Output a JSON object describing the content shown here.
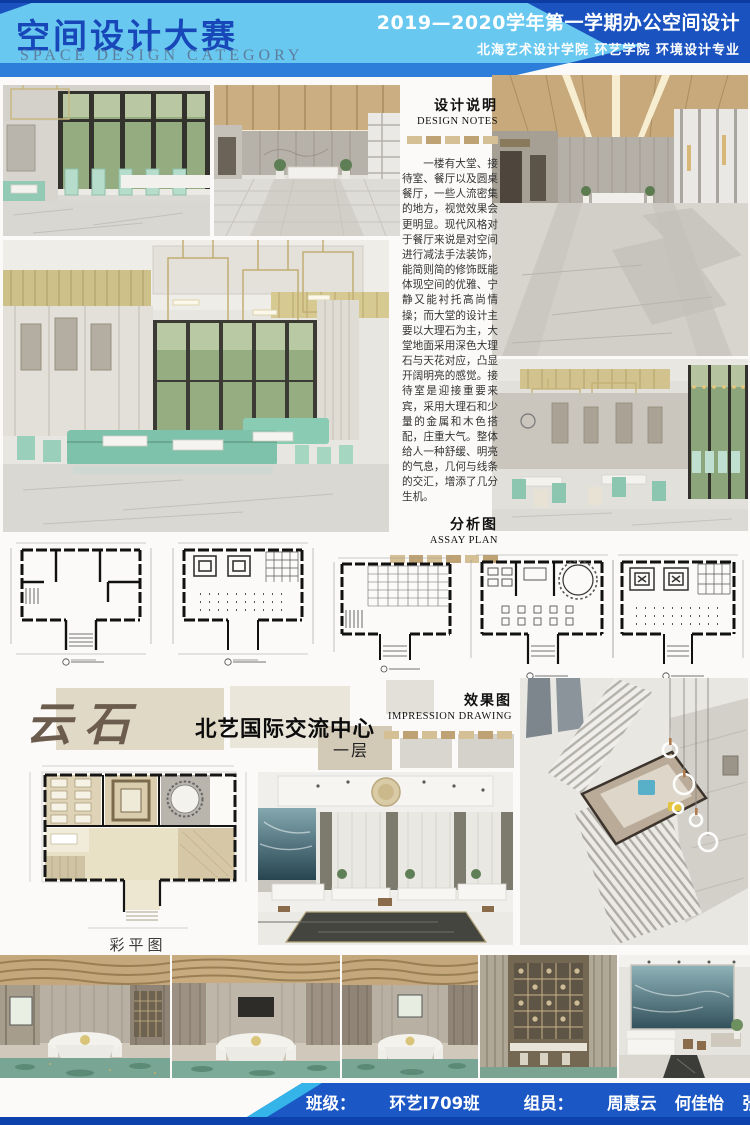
{
  "poster": {
    "header": {
      "title_cn": "空间设计大赛",
      "title_en": "SPACE DESIGN CATEGORY",
      "term_line": "2019—2020学年第一学期办公空间设计",
      "school_line": "北海艺术设计学院 环艺学院 环境设计专业"
    },
    "design_notes": {
      "title_cn": "设计说明",
      "title_en": "DESIGN NOTES",
      "body": "一楼有大堂、接待室、餐厅以及圆桌餐厅，一些人流密集的地方，视觉效果会更明显。现代风格对于餐厅来说是对空间进行减法手法装饰，能简则简的修饰既能体现空间的优雅、宁静又能衬托高尚情操；而大堂的设计主要以大理石为主，大堂地面采用深色大理石与天花对应，凸显开阔明亮的感觉。接待室是迎接重要来宾，采用大理石和少量的金属和木色搭配，庄重大气。整体给人一种舒缓、明亮的气息，几何与线条的交汇，增添了几分生机。"
    },
    "assay_plan": {
      "title_cn": "分析图",
      "title_en": "ASSAY PLAN"
    },
    "impression": {
      "title_cn": "效果图",
      "title_en": "IMPRESSION DRAWING"
    },
    "branding": {
      "logo": "云石",
      "project_name": "北艺国际交流中心",
      "floor_tag": "一层"
    },
    "color_plan_caption": "彩平图",
    "footer": {
      "class_label": "班级：",
      "class_value": "环艺I709班",
      "members_label": "组员：",
      "member1": "周惠云",
      "member2": "何佳怡",
      "member3": "张婕"
    },
    "colors": {
      "banner_dark_blue": "#1a53c0",
      "banner_light_blue": "#68c8f0",
      "banner_mid_blue": "#2d7edb",
      "footer_cyan": "#34b4e9",
      "accent_tan": "#bfa273",
      "logo_brown": "#6b5c4e",
      "teal_furniture": "#83c3ac"
    }
  }
}
